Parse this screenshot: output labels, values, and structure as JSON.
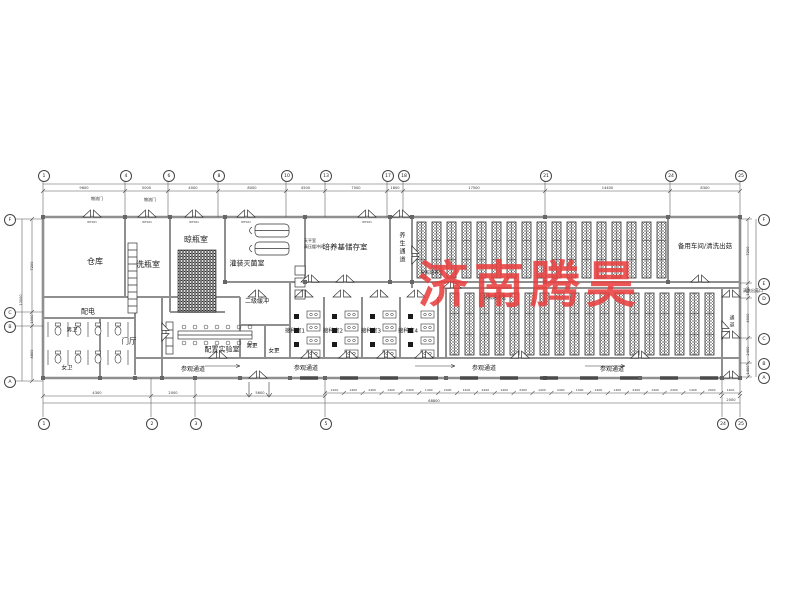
{
  "watermark": {
    "text": "济南腾昊",
    "color": "#e8403f"
  },
  "grid": {
    "top": [
      [
        "1",
        43
      ],
      [
        "4",
        125
      ],
      [
        "6",
        168
      ],
      [
        "8",
        218
      ],
      [
        "10",
        286
      ],
      [
        "13",
        325
      ],
      [
        "17",
        387
      ],
      [
        "18",
        403
      ],
      [
        "21",
        545
      ],
      [
        "24",
        670
      ],
      [
        "25",
        740
      ]
    ],
    "bottom": [
      [
        "1",
        43
      ],
      [
        "2",
        151
      ],
      [
        "3",
        195
      ],
      [
        "5",
        325
      ],
      [
        "24",
        722
      ],
      [
        "25",
        740
      ]
    ],
    "left": [
      [
        "F",
        219
      ],
      [
        "C",
        312
      ],
      [
        "B",
        326
      ],
      [
        "A",
        381
      ]
    ],
    "right": [
      [
        "F",
        219
      ],
      [
        "E",
        283
      ],
      [
        "D",
        298
      ],
      [
        "C",
        338
      ],
      [
        "B",
        363
      ],
      [
        "A",
        377
      ]
    ]
  },
  "dims": {
    "top": [
      "9600",
      "5000",
      "4000",
      "8000",
      "4500",
      "7500",
      "1800",
      "17500",
      "14400",
      "8300"
    ],
    "bottom_left": [
      "4300",
      "2000",
      "5600"
    ],
    "bottom_ticks": [
      "2100",
      "1400",
      "2400",
      "1400",
      "2400",
      "1400",
      "2400",
      "1400",
      "2400",
      "1400",
      "2400",
      "1400",
      "2400",
      "1400",
      "2400",
      "1400",
      "2400",
      "1400",
      "2400",
      "1400",
      "2400",
      "1400"
    ],
    "bottom_total": "68800",
    "bottom_right": "2000",
    "left": [
      "7200",
      "1000",
      "4800"
    ],
    "left_total": "13000",
    "right": [
      "7200",
      "1500",
      "4000",
      "2400",
      "1400"
    ]
  },
  "door_tag": "WT021",
  "labels": [
    {
      "t": "仓库",
      "x": 95,
      "y": 262,
      "s": 8,
      "v": false
    },
    {
      "t": "洗瓶室",
      "x": 148,
      "y": 265,
      "s": 8,
      "v": false
    },
    {
      "t": "晾瓶室",
      "x": 196,
      "y": 240,
      "s": 8,
      "v": false
    },
    {
      "t": "灌装灭菌室",
      "x": 247,
      "y": 264,
      "s": 7,
      "v": false
    },
    {
      "t": "培养基储存室",
      "x": 345,
      "y": 247,
      "s": 7.5,
      "v": false
    },
    {
      "t": "养生通道",
      "x": 401,
      "y": 248,
      "s": 6,
      "v": true
    },
    {
      "t": "光照培养室",
      "x": 432,
      "y": 274,
      "s": 4.5,
      "v": false
    },
    {
      "t": "备用车间/清洗出菇",
      "x": 705,
      "y": 246,
      "s": 6.5,
      "v": false
    },
    {
      "t": "二级缓冲",
      "x": 257,
      "y": 302,
      "s": 6,
      "v": false
    },
    {
      "t": "配电",
      "x": 88,
      "y": 312,
      "s": 7,
      "v": false
    },
    {
      "t": "男卫",
      "x": 72,
      "y": 331,
      "s": 5.5,
      "v": false
    },
    {
      "t": "女卫",
      "x": 67,
      "y": 369,
      "s": 5.5,
      "v": false
    },
    {
      "t": "门厅",
      "x": 129,
      "y": 341,
      "s": 7.5,
      "v": false
    },
    {
      "t": "配置实验室",
      "x": 222,
      "y": 350,
      "s": 7,
      "v": false
    },
    {
      "t": "男更",
      "x": 252,
      "y": 347,
      "s": 5.5,
      "v": false
    },
    {
      "t": "女更",
      "x": 274,
      "y": 352,
      "s": 5.5,
      "v": false
    },
    {
      "t": "接种室1",
      "x": 295,
      "y": 332,
      "s": 5.5,
      "v": false
    },
    {
      "t": "接种室2",
      "x": 333,
      "y": 332,
      "s": 5.5,
      "v": false
    },
    {
      "t": "接种室3",
      "x": 371,
      "y": 332,
      "s": 5.5,
      "v": false
    },
    {
      "t": "接种室4",
      "x": 408,
      "y": 332,
      "s": 5.5,
      "v": false
    },
    {
      "t": "光照培养室",
      "x": 495,
      "y": 299,
      "s": 4.5,
      "v": false
    },
    {
      "t": "参观通道",
      "x": 193,
      "y": 370,
      "s": 6,
      "v": false
    },
    {
      "t": "参观通道",
      "x": 306,
      "y": 369,
      "s": 6,
      "v": false
    },
    {
      "t": "参观通道",
      "x": 484,
      "y": 369,
      "s": 6,
      "v": false
    },
    {
      "t": "参观通道",
      "x": 612,
      "y": 370,
      "s": 6,
      "v": false
    },
    {
      "t": "通道",
      "x": 731,
      "y": 322,
      "s": 5,
      "v": true
    },
    {
      "t": "清洗出菇口",
      "x": 753,
      "y": 291,
      "s": 4,
      "v": false
    },
    {
      "t": "物流门",
      "x": 97,
      "y": 199,
      "s": 4,
      "v": false
    },
    {
      "t": "物流门",
      "x": 150,
      "y": 200,
      "s": 4,
      "v": false
    },
    {
      "t": "天平室",
      "x": 310,
      "y": 241,
      "s": 4,
      "v": false
    },
    {
      "t": "高压缓冲间",
      "x": 314,
      "y": 247,
      "s": 4,
      "v": false
    }
  ]
}
